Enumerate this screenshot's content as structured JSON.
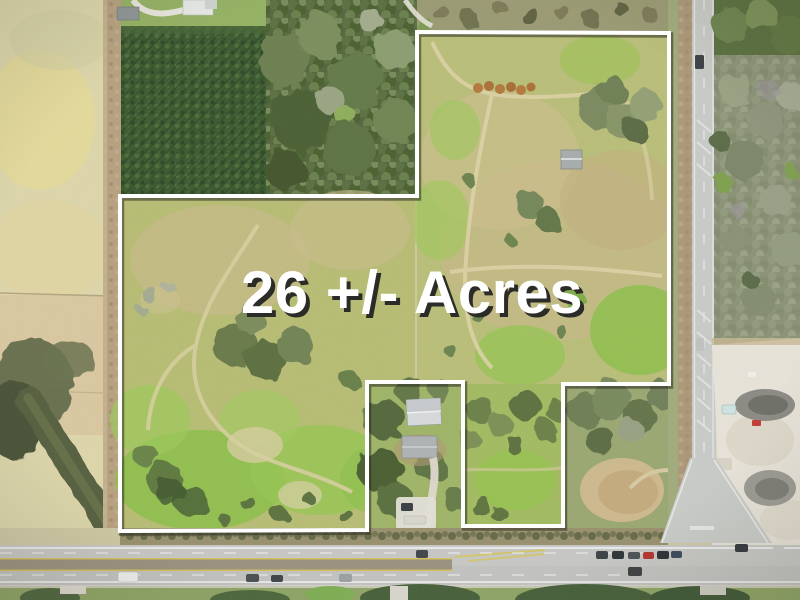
{
  "image": {
    "width": 800,
    "height": 600,
    "kind": "aerial-drone-photo"
  },
  "overlay": {
    "acreage_label": "26 +/- Acres",
    "label_color": "#ffffff",
    "label_shadow_color": "#2b2b27",
    "boundary_color": "#ffffff",
    "boundary_shadow_color": "rgba(45,45,35,0.55)",
    "boundary_points": "417,32 669,33 669,384 563,384 563,526 463,526 463,382 367,382 367,530 120,531 120,196 417,196"
  },
  "palette": {
    "field_pale": "#ddd6ab",
    "pine_forest": "#3d5a30",
    "mixed_woods": "#55673e",
    "parcel_grass": "#b7bd74",
    "bright_grass": "#8fc24a",
    "dirt_path": "#d9d0a2",
    "road_pavement": "#c7c8c5",
    "sand_pit": "#e7e3d9",
    "scrub": "#8b9377"
  }
}
